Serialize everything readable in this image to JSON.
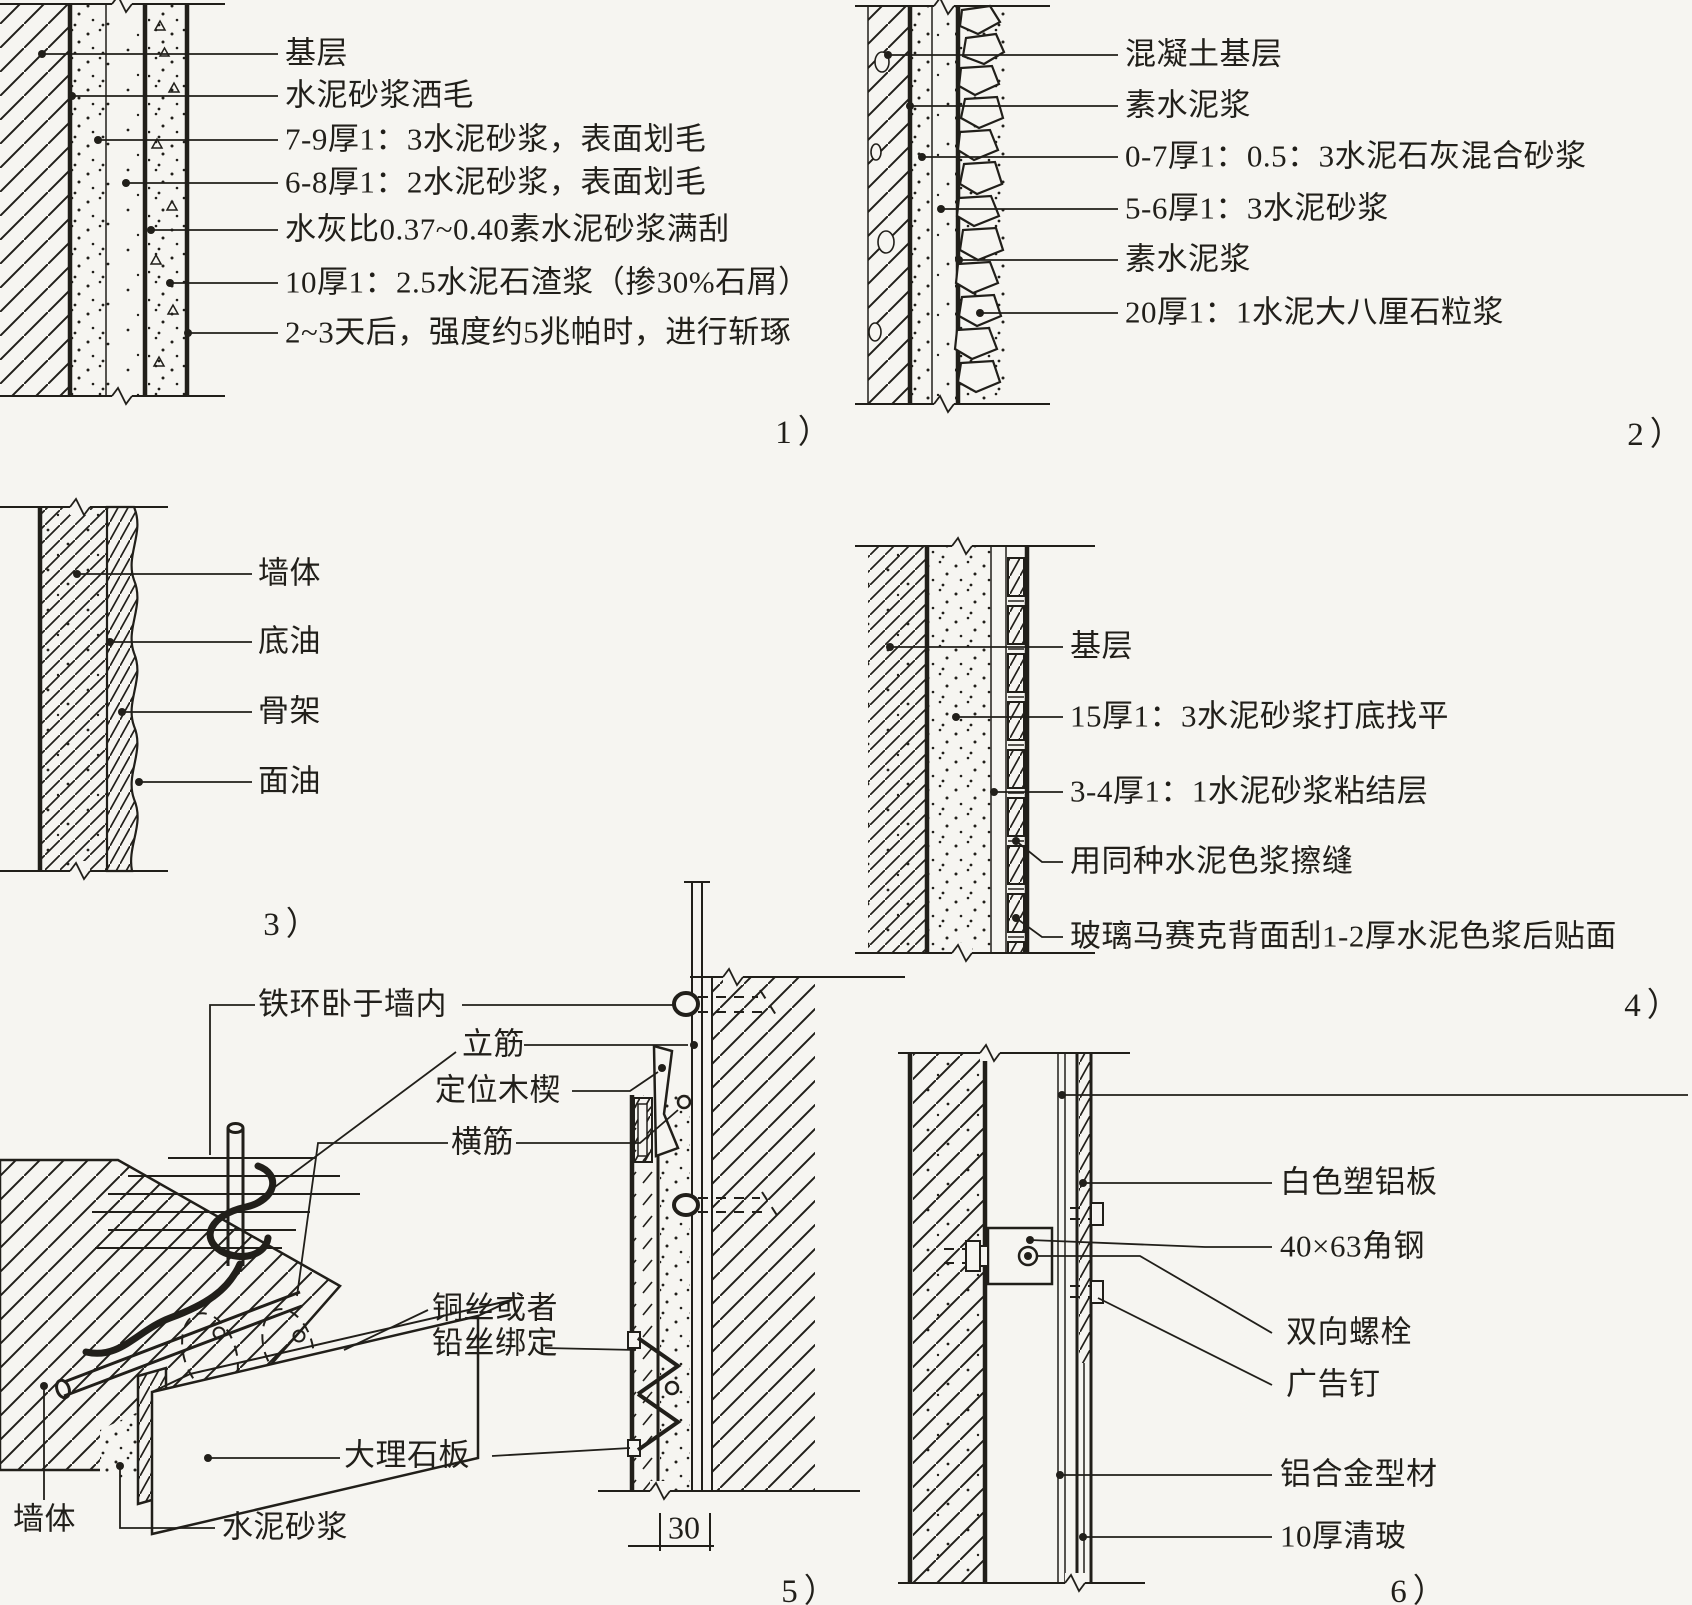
{
  "figure_type": "wall-finish-construction-details",
  "colors": {
    "ink": "#211f1a",
    "paper": "#f6f5f1"
  },
  "panels": {
    "p1": {
      "caption": "1）",
      "labels": [
        "基层",
        "水泥砂浆洒毛",
        "7-9厚1：3水泥砂浆，表面划毛",
        "6-8厚1：2水泥砂浆，表面划毛",
        "水灰比0.37~0.40素水泥砂浆满刮",
        "10厚1：2.5水泥石渣浆（掺30%石屑）",
        "2~3天后，强度约5兆帕时，进行斩琢"
      ]
    },
    "p2": {
      "caption": "2）",
      "labels": [
        "混凝土基层",
        "素水泥浆",
        "0-7厚1：0.5：3水泥石灰混合砂浆",
        "5-6厚1：3水泥砂浆",
        "素水泥浆",
        "20厚1：1水泥大八厘石粒浆"
      ]
    },
    "p3": {
      "caption": "3）",
      "labels": [
        "墙体",
        "底油",
        "骨架",
        "面油"
      ]
    },
    "p4": {
      "caption": "4）",
      "labels": [
        "基层",
        "15厚1：3水泥砂浆打底找平",
        "3-4厚1：1水泥砂浆粘结层",
        "用同种水泥色浆擦缝",
        "玻璃马赛克背面刮1-2厚水泥色浆后贴面"
      ]
    },
    "p5": {
      "caption": "5）",
      "dimension": "30",
      "labels": {
        "iron_ring": "铁环卧于墙内",
        "vertical_bar": "立筋",
        "wedge": "定位木楔",
        "horizontal_bar": "横筋",
        "wire_tie": "铜丝或者铅丝绑定",
        "marble_slab": "大理石板",
        "wall": "墙体",
        "cement_mortar": "水泥砂浆"
      }
    },
    "p6": {
      "caption": "6）",
      "labels": [
        "白色塑铝板",
        "40×63角钢",
        "双向螺栓",
        "广告钉",
        "铝合金型材",
        "10厚清玻"
      ]
    }
  }
}
